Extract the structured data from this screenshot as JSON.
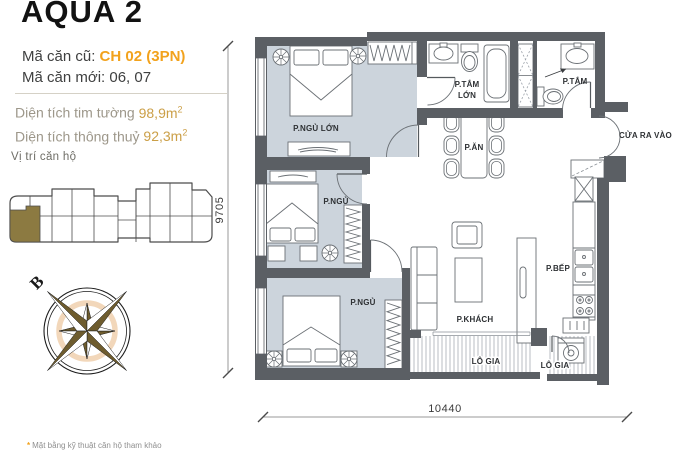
{
  "panel": {
    "title": "AQUA 2",
    "old_code_label": "Mã căn cũ:",
    "old_code_value": "CH 02 (3PN)",
    "new_code_label": "Mã căn mới:",
    "new_code_value": "06, 07",
    "gross_area_label": "Diện tích tim tường",
    "gross_area_value": "98,9m",
    "net_area_label": "Diện tích thông thuỷ",
    "net_area_value": "92,3m",
    "sup": "2",
    "location_label": "Vị trí căn hộ",
    "footnote_bullet": "*",
    "footnote": "Mặt bằng kỹ thuật căn hộ tham khảo"
  },
  "compass": {
    "north_label": "B"
  },
  "plan": {
    "rooms": {
      "master_bedroom": "P.NGỦ LỚN",
      "bathroom_large_line1": "P.TẮM",
      "bathroom_large_line2": "LỚN",
      "bathroom": "P.TẮM",
      "dining": "P.ĂN",
      "bedroom_2": "P.NGỦ",
      "bedroom_3": "P.NGỦ",
      "living": "P.KHÁCH",
      "kitchen": "P.BẾP",
      "loggia_1": "LÔ GIA",
      "loggia_2": "LÔ GIA",
      "entrance": "CỬA RA VÀO"
    },
    "dimensions": {
      "height": "9705",
      "width": "10440"
    }
  },
  "colors": {
    "accent_orange": "#F2A21C",
    "area_value_gold": "#CB9F47",
    "floor_blue_gray": "#CCD4DC",
    "wall_gray": "#5B5F64",
    "unit_highlight_olive": "#8C7A41"
  }
}
